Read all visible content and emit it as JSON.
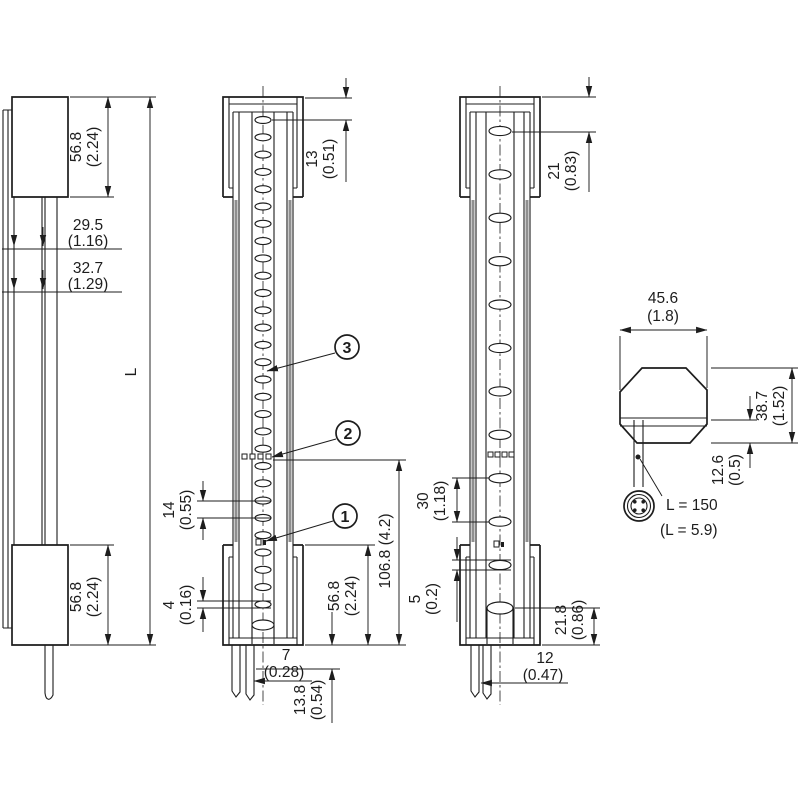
{
  "drawing": {
    "description": "Dimensional technical drawing: three orthographic views of a light curtain sensor bar with cross-section profile and M12 cable connector detail",
    "units": "mm (inch)",
    "callouts": [
      {
        "label": "1"
      },
      {
        "label": "2"
      },
      {
        "label": "3"
      }
    ],
    "side_view": {
      "top_cap": {
        "mm": "56.8",
        "inch": "(2.24)"
      },
      "upper_offset": {
        "mm": "29.5",
        "inch": "(1.16)"
      },
      "lower_offset": {
        "mm": "32.7",
        "inch": "(1.29)"
      },
      "length": "L",
      "bottom_cap": {
        "mm": "56.8",
        "inch": "(2.24)"
      }
    },
    "front_view_fine": {
      "first_beam": {
        "mm": "13",
        "inch": "(0.51)"
      },
      "beam_pitch": {
        "mm": "14",
        "inch": "(0.55)"
      },
      "lens_height": {
        "mm": "4",
        "inch": "(0.16)"
      },
      "lower_section": "106.8 (4.2)",
      "bottom_cap": {
        "mm": "56.8",
        "inch": "(2.24)"
      },
      "cable_offset": {
        "mm": "7",
        "inch": "(0.28)"
      },
      "cable_drop": {
        "mm": "13.8",
        "inch": "(0.54)"
      }
    },
    "front_view_coarse": {
      "first_beam": {
        "mm": "21",
        "inch": "(0.83)"
      },
      "beam_pitch": {
        "mm": "30",
        "inch": "(1.18)"
      },
      "lens_height": {
        "mm": "5",
        "inch": "(0.2)"
      },
      "last_beam": {
        "mm": "21.8",
        "inch": "(0.86)"
      },
      "cable_offset": {
        "mm": "12",
        "inch": "(0.47)"
      }
    },
    "cross_section": {
      "width": {
        "mm": "45.6",
        "inch": "(1.8)"
      },
      "height": {
        "mm": "38.7",
        "inch": "(1.52)"
      },
      "cable_zone": {
        "mm": "12.6",
        "inch": "(0.5)"
      },
      "cable_length": "L = 150",
      "cable_length_inch": "(L = 5.9)"
    }
  }
}
